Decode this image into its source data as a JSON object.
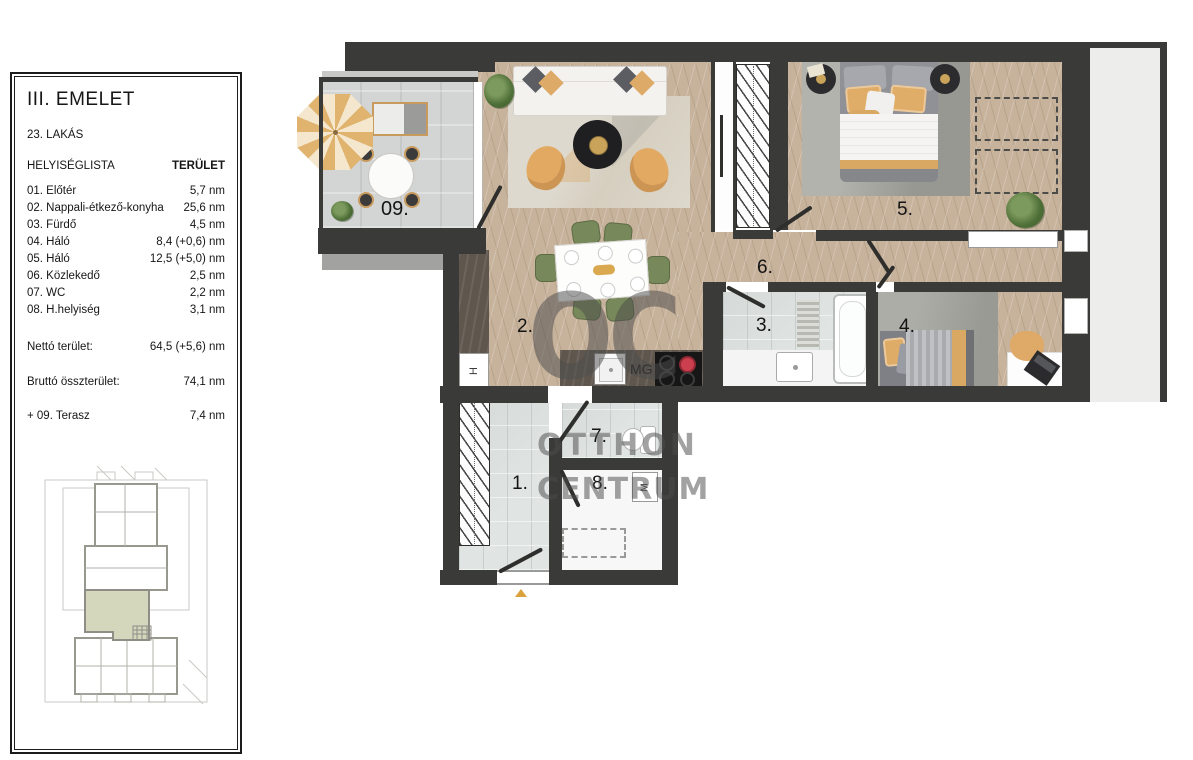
{
  "panel": {
    "title": "III. EMELET",
    "apartment": "23. LAKÁS",
    "list_header": "HELYISÉGLISTA",
    "area_header": "TERÜLET",
    "rooms": [
      {
        "label": "01. Előtér",
        "area": "5,7 nm"
      },
      {
        "label": "02. Nappali-étkező-konyha",
        "area": "25,6 nm"
      },
      {
        "label": "03. Fürdő",
        "area": "4,5 nm"
      },
      {
        "label": "04. Háló",
        "area": "8,4 (+0,6) nm"
      },
      {
        "label": "05. Háló",
        "area": "12,5 (+5,0) nm"
      },
      {
        "label": "06. Közlekedő",
        "area": "2,5 nm"
      },
      {
        "label": "07. WC",
        "area": "2,2 nm"
      },
      {
        "label": "08. H.helyiség",
        "area": "3,1 nm"
      }
    ],
    "net": {
      "label": "Nettó terület:",
      "value": "64,5 (+5,6) nm"
    },
    "gross": {
      "label": "Bruttó összterület:",
      "value": "74,1 nm"
    },
    "terrace": {
      "label": "+ 09. Terasz",
      "value": "7,4 nm"
    }
  },
  "plan": {
    "room_labels": {
      "r1": "1.",
      "r2": "2.",
      "r3": "3.",
      "r4": "4.",
      "r5": "5.",
      "r6": "6.",
      "r7": "7.",
      "r8": "8.",
      "r9": "09."
    },
    "appliances": {
      "fridge": "H",
      "dishwasher": "MG",
      "washer": "M"
    },
    "watermark": {
      "logo": "OC",
      "line1": "OTTHON",
      "line2": "CENTRUM"
    }
  },
  "colors": {
    "wall": "#3a3a38",
    "wood_floor": "#c7b29b",
    "terrace_concrete": "#d3d5d4",
    "tile": "#e0e4e3",
    "accent_tan": "#ddaa66",
    "chair_green": "#77885b",
    "kitchen_counter": "#5f564d",
    "minimap_highlight": "#d4d7bc",
    "watermark_gray": "#4c4c4c",
    "entrance_marker": "#d9a23c"
  }
}
